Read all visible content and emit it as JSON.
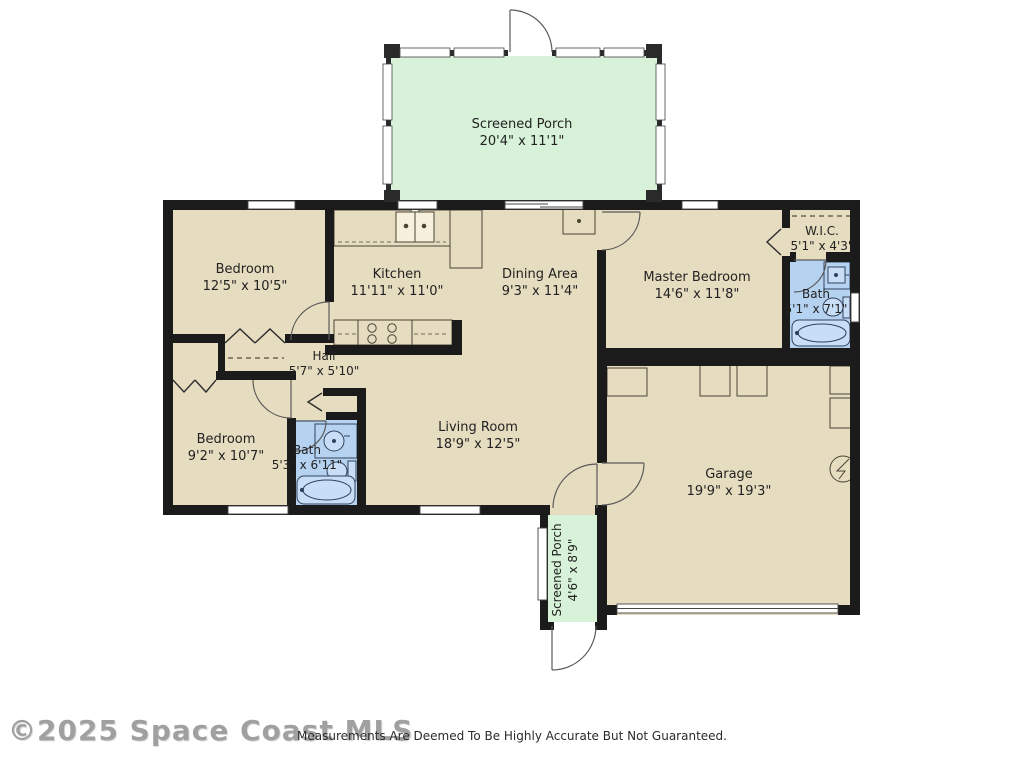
{
  "colors": {
    "floor": "#e6dcc0",
    "porch_green": "#d7f2d8",
    "bath_blue": "#b5d2f0",
    "wall": "#1b1b1b",
    "fixture_outline": "#4a4435"
  },
  "rooms": {
    "screened_porch_top": {
      "name": "Screened Porch",
      "dims": "20'4\" x 11'1\""
    },
    "bedroom_top": {
      "name": "Bedroom",
      "dims": "12'5\" x 10'5\""
    },
    "kitchen": {
      "name": "Kitchen",
      "dims": "11'11\" x 11'0\""
    },
    "dining": {
      "name": "Dining Area",
      "dims": "9'3\" x 11'4\""
    },
    "master_bedroom": {
      "name": "Master Bedroom",
      "dims": "14'6\" x 11'8\""
    },
    "wic": {
      "name": "W.I.C.",
      "dims": "5'1\" x 4'3\""
    },
    "master_bath": {
      "name": "Bath",
      "dims": "5'1\" x 7'1\""
    },
    "hall": {
      "name": "Hall",
      "dims": "5'7\" x 5'10\""
    },
    "bedroom_bottom": {
      "name": "Bedroom",
      "dims": "9'2\" x 10'7\""
    },
    "bath_second": {
      "name": "Bath",
      "dims": "5'3\" x 6'11\""
    },
    "living_room": {
      "name": "Living Room",
      "dims": "18'9\" x 12'5\""
    },
    "garage": {
      "name": "Garage",
      "dims": "19'9\" x 19'3\""
    },
    "screened_porch_bottom": {
      "name": "Screened Porch",
      "dims": "4'6\" x 8'9\""
    }
  },
  "watermark": "©2025 Space Coast MLS",
  "footer": "Measurements Are Deemed To Be Highly Accurate But Not Guaranteed."
}
